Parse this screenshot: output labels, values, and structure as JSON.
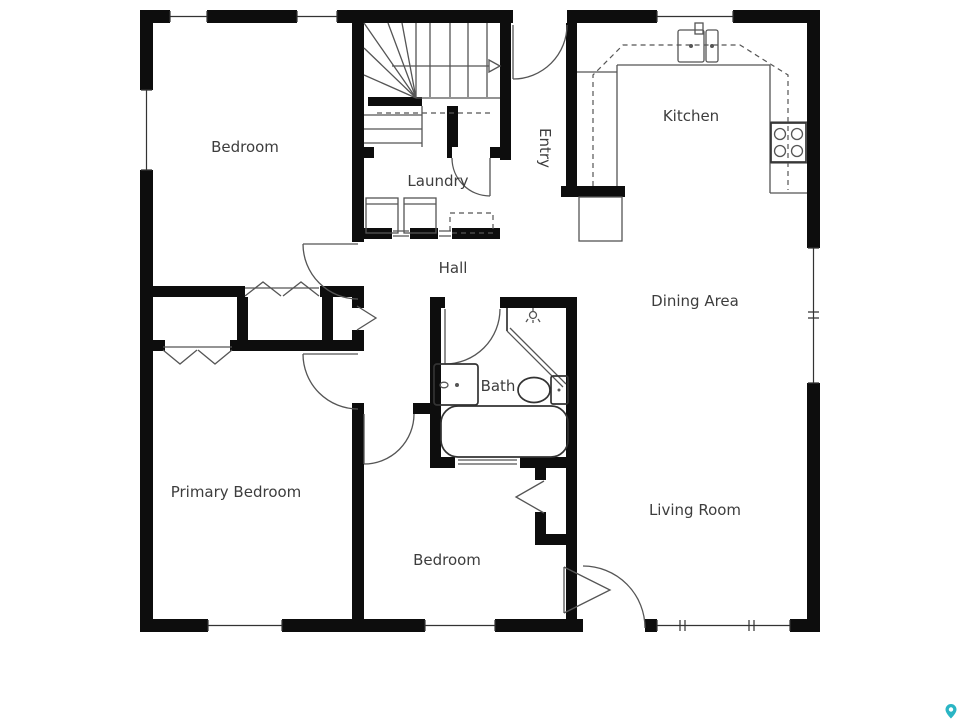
{
  "page": {
    "background": "#ffffff"
  },
  "floor_plan": {
    "labels": {
      "bedroom_top": "Bedroom",
      "laundry": "Laundry",
      "entry": "Entry",
      "kitchen": "Kitchen",
      "hall": "Hall",
      "dining_area": "Dining Area",
      "bath": "Bath",
      "primary_bedroom": "Primary Bedroom",
      "bedroom_bottom": "Bedroom",
      "living_room": "Living Room"
    },
    "colors": {
      "wall": "#0d0d0d",
      "fixture_line": "#555555",
      "bold_fixture_line": "#333333",
      "label_text": "#3d3d3d",
      "watermark": "#2ab5c4"
    },
    "stairs": {
      "direction_arrow": "right"
    },
    "fixtures": [
      "staircase",
      "washer",
      "dryer",
      "kitchen-sink",
      "stove",
      "refrigerator",
      "upper-cabinets",
      "shower",
      "vanity-sink",
      "toilet",
      "bathtub"
    ],
    "watermark": {
      "shape": "map-pin"
    }
  }
}
